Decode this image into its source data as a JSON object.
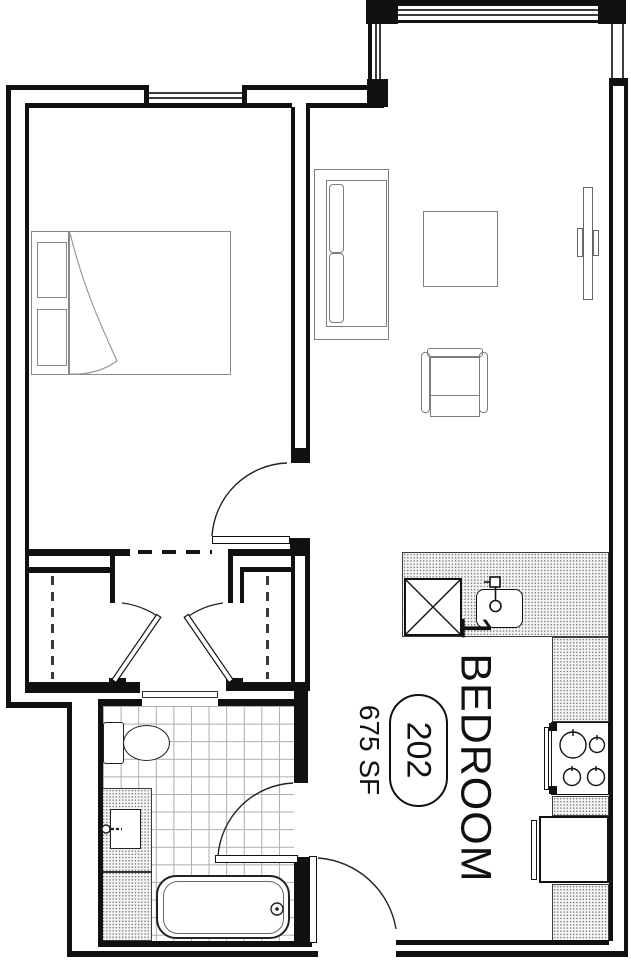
{
  "unit": {
    "type_label": "1 BEDROOM",
    "number": "202",
    "area": "675 SF"
  },
  "colors": {
    "background": "#ffffff",
    "wall": "#111111",
    "glazing": "#3c3c3c",
    "furniture_line": "#7d7d7d",
    "fixture_line": "#222222",
    "tile_line": "#a9aeb3",
    "counter_stipple": "#7e8287",
    "text": "#111111"
  },
  "fixtures": [
    "bed",
    "pillows",
    "closet-rod-left",
    "closet-rod-right",
    "sofa",
    "coffee-table",
    "armchair",
    "tv",
    "kitchen-counter",
    "dishwasher",
    "kitchen-sink",
    "range",
    "refrigerator",
    "toilet",
    "vanity-sink",
    "bathtub"
  ]
}
